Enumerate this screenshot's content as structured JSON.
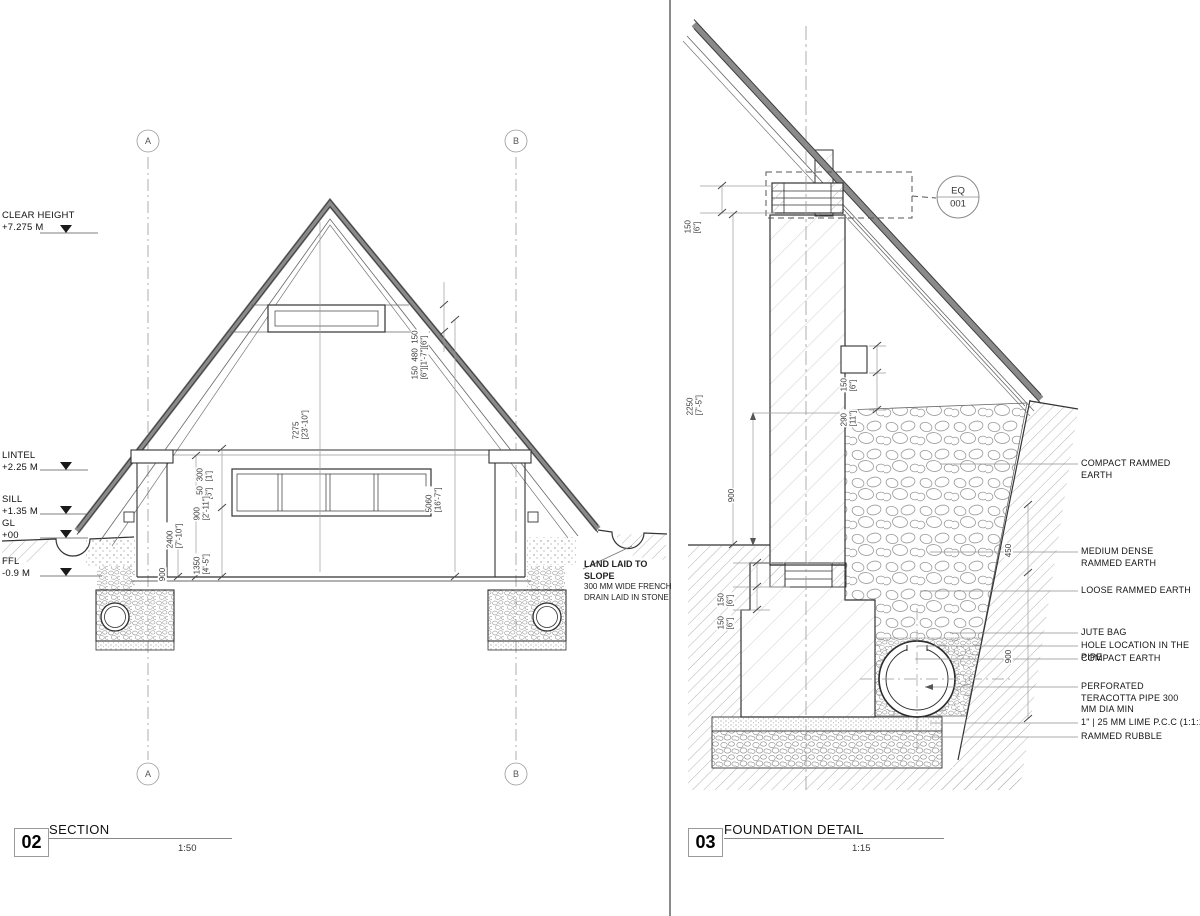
{
  "section": {
    "title": {
      "number": "02",
      "name": "SECTION",
      "scale": "1:50"
    },
    "grid": {
      "left": "A",
      "right": "B"
    },
    "levels": [
      {
        "label": "CLEAR HEIGHT",
        "value": "+7.275 M"
      },
      {
        "label": "LINTEL",
        "value": "+2.25 M"
      },
      {
        "label": "SILL",
        "value": "+1.35 M"
      },
      {
        "label": "GL",
        "value": "+00"
      },
      {
        "label": "FFL",
        "value": "-0.9 M"
      }
    ],
    "dims": {
      "vent": {
        "metric": "150  480  150",
        "imperial": "[6\"][1'-7\"][6\"]"
      },
      "ridge": {
        "metric": "7275",
        "imperial": "[23'-10\"]"
      },
      "span": {
        "metric": "5060",
        "imperial": "[16'-7\"]"
      },
      "band300": {
        "metric": "300",
        "imperial": "[1']"
      },
      "band150": {
        "metric": "150",
        "imperial": "[6\"]"
      },
      "window900": {
        "metric": "900",
        "imperial": "[2'-11\"]"
      },
      "wall2400": {
        "metric": "2400",
        "imperial": "[7'-10\"]"
      },
      "sill1350": {
        "metric": "1350",
        "imperial": "[4'-5\"]"
      },
      "found900": {
        "metric": "900",
        "imperial": ""
      }
    },
    "note": [
      "LAND LAID TO SLOPE",
      "300 MM WIDE FRENCH",
      "DRAIN LAID IN STONE"
    ]
  },
  "detail": {
    "title": {
      "number": "03",
      "name": "FOUNDATION DETAIL",
      "scale": "1:15"
    },
    "callout": {
      "top": "EQ",
      "bottom": "001"
    },
    "dims": {
      "plate150": {
        "metric": "150",
        "imperial": "[6\"]"
      },
      "wall2250": {
        "metric": "2250",
        "imperial": "[7'-5\"]"
      },
      "found900": {
        "metric": "900",
        "imperial": ""
      },
      "purlin150": {
        "metric": "150",
        "imperial": "[6\"]"
      },
      "purlin290": {
        "metric": "290",
        "imperial": "[11\"]"
      },
      "band150a": {
        "metric": "150",
        "imperial": "[6\"]"
      },
      "band150b": {
        "metric": "150",
        "imperial": "[6\"]"
      },
      "layer450": {
        "metric": "450",
        "imperial": ""
      },
      "layer900": {
        "metric": "900",
        "imperial": ""
      }
    },
    "labels": [
      {
        "text": "COMPACT RAMMED EARTH"
      },
      {
        "text": "MEDIUM DENSE RAMMED EARTH"
      },
      {
        "text": "LOOSE RAMMED EARTH"
      },
      {
        "text": "JUTE BAG"
      },
      {
        "text": "HOLE LOCATION IN THE PIPE"
      },
      {
        "text": "COMPACT EARTH"
      },
      {
        "text": "PERFORATED TERACOTTA PIPE 300 MM DIA MIN"
      },
      {
        "text": "1\" | 25 MM LIME P.C.C (1:1:1)"
      },
      {
        "text": "RAMMED RUBBLE"
      }
    ]
  }
}
